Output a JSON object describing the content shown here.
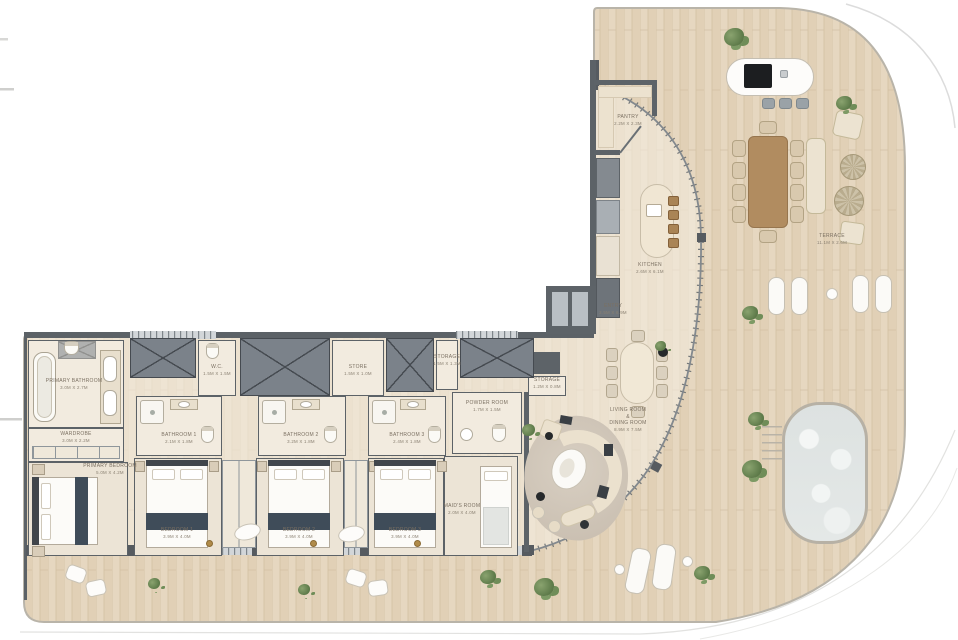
{
  "plan_title": "penthouse-floor-plan",
  "rooms": {
    "pantry": {
      "label": "PANTRY",
      "dims": "2.2M X 2.3M"
    },
    "kitchen": {
      "label": "KITCHEN",
      "dims": "2.6M X 6.1M"
    },
    "entry": {
      "label": "ENTRY",
      "dims": "2.5M X 6.9M"
    },
    "living": {
      "l1": "LIVING ROOM",
      "l2": "&",
      "l3": "DINING ROOM",
      "dims": "8.9M X 7.5M"
    },
    "terrace": {
      "label": "TERRACE",
      "dims": "11.1M X 2.6M"
    },
    "primary_bathroom": {
      "label": "PRIMARY BATHROOM",
      "dims": "3.0M X 2.7M"
    },
    "wardrobe": {
      "label": "WARDROBE",
      "dims": "3.0M X 2.2M"
    },
    "primary_bedroom": {
      "label": "PRIMARY BEDROOM",
      "dims": "5.0M X 4.2M"
    },
    "wc": {
      "label": "W.C.",
      "dims": "1.5M X 1.5M"
    },
    "store": {
      "label": "STORE",
      "dims": "1.5M X 1.0M"
    },
    "storage1": {
      "label": "STORAGE",
      "dims": "1.5M X 1.3M"
    },
    "storage2": {
      "label": "STORAGE",
      "dims": "1.2M X 0.8M"
    },
    "powder": {
      "label": "POWDER ROOM",
      "dims": "1.7M X 1.5M"
    },
    "bathroom1": {
      "label": "BATHROOM 1",
      "dims": "2.1M X 1.8M"
    },
    "bathroom2": {
      "label": "BATHROOM 2",
      "dims": "3.2M X 1.8M"
    },
    "bathroom3": {
      "label": "BATHROOM 3",
      "dims": "2.4M X 1.8M"
    },
    "bedroom1": {
      "label": "BEDROOM 1",
      "dims": "3.9M X 4.0M"
    },
    "bedroom2": {
      "label": "BEDROOM 2",
      "dims": "3.9M X 4.0M"
    },
    "bedroom3": {
      "label": "BEDROOM 3",
      "dims": "3.9M X 4.0M"
    },
    "maid": {
      "label": "MAID'S ROOM",
      "dims": "2.0M X 4.0M"
    }
  },
  "colors": {
    "wood": "#e6d7c0",
    "wood_indoor": "#f2ebdf",
    "wall": "#5c6267",
    "glass": "#83898e",
    "navy_accent": "#3f4c59",
    "table_wood": "#b18c60",
    "cream_furniture": "#ece3d1",
    "pool_water": "#e2e6e5",
    "plant_green": "#6f8d58",
    "label_text": "#7b7062"
  }
}
